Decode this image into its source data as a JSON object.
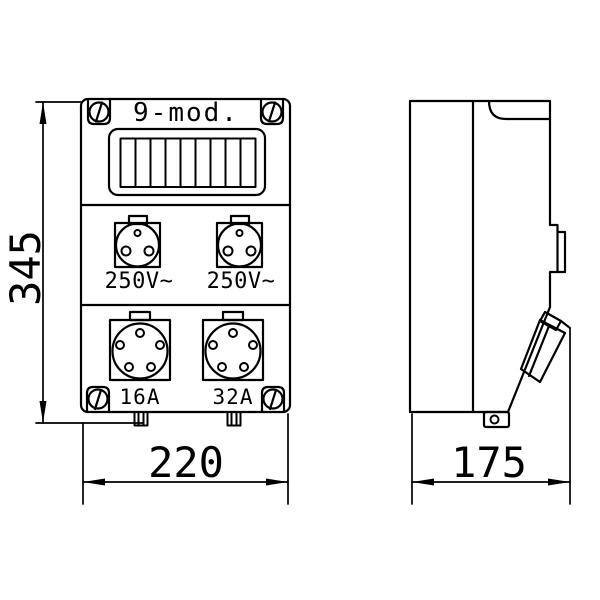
{
  "drawing": {
    "type": "technical-dimension-drawing",
    "subject": "electrical distribution box, front and side view",
    "colors": {
      "line": "#000000",
      "background": "#ffffff"
    }
  },
  "front_view": {
    "module_label": "9-mod.",
    "module_slots": 9,
    "socket_small_1_label": "250V~",
    "socket_small_2_label": "250V~",
    "socket_large_1_label": "16A",
    "socket_large_2_label": "32A"
  },
  "dimensions": {
    "height_mm": "345",
    "width_mm": "220",
    "depth_mm": "175"
  }
}
